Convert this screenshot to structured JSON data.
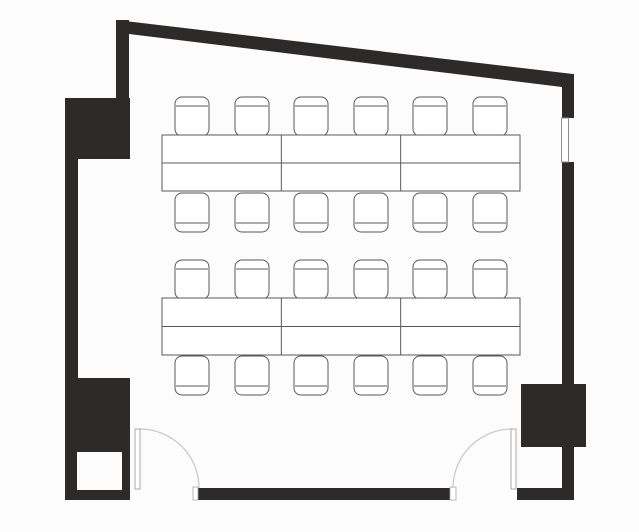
{
  "meta": {
    "drawing_type": "floor-plan",
    "room_description": "classroom seating plan",
    "table_count": 12,
    "chair_count": 24,
    "door_count": 2,
    "window_count": 1
  },
  "canvas": {
    "width": 639,
    "height": 532,
    "background": "#fcfcfc"
  },
  "style": {
    "wall_fill": "#2d2b29",
    "furniture_stroke": "#585858",
    "furniture_fill": "#ffffff",
    "arc_stroke": "#c7c7c7",
    "leaf_stroke": "#a8a8a8",
    "window_stroke": "#8f8f8f",
    "void_fill": "#fcfcfc"
  },
  "walls": [
    {
      "name": "wall-top-diagonal",
      "points": "116,20 573,74 573,88 562,87 129,34 116,33"
    },
    {
      "name": "wall-left-upper",
      "rect": [
        116,
        20,
        13,
        79
      ]
    },
    {
      "name": "wall-left-pillar",
      "rect": [
        65,
        98,
        65,
        61
      ]
    },
    {
      "name": "wall-left-strip",
      "rect": [
        65,
        158,
        13,
        221
      ]
    },
    {
      "name": "wall-left-lower-block",
      "rect": [
        65,
        378,
        65,
        122
      ]
    },
    {
      "name": "wall-bottom-left",
      "rect": [
        198,
        488,
        252,
        12
      ]
    },
    {
      "name": "wall-bottom-right",
      "rect": [
        517,
        488,
        57,
        12
      ]
    },
    {
      "name": "wall-right-lower",
      "rect": [
        562,
        446,
        12,
        54
      ]
    },
    {
      "name": "wall-right-column",
      "rect": [
        521,
        384,
        65,
        63
      ]
    },
    {
      "name": "wall-right-mid",
      "rect": [
        562,
        162,
        12,
        222
      ]
    },
    {
      "name": "wall-right-top",
      "rect": [
        562,
        74,
        12,
        44
      ]
    }
  ],
  "voids": [
    {
      "name": "wall-niche",
      "rect": [
        77,
        452,
        45,
        38
      ]
    }
  ],
  "window": {
    "name": "window-right",
    "rect": [
      561.5,
      118,
      7,
      44
    ]
  },
  "door_jambs": [
    {
      "name": "door-jamb-left",
      "rect": [
        193,
        487,
        5,
        13
      ]
    },
    {
      "name": "door-jamb-right",
      "rect": [
        450,
        487,
        6,
        13
      ]
    }
  ],
  "doors": [
    {
      "name": "door-left",
      "leaf": [
        135,
        429,
        5,
        60
      ],
      "arc": "M 140 429 A 59 59 0 0 1 199 488"
    },
    {
      "name": "door-right",
      "leaf": [
        511,
        429,
        5,
        60
      ],
      "arc": "M 512 429 A 59 59 0 0 0 453 488"
    }
  ],
  "table_bands": [
    {
      "name": "table-band-top",
      "x": 162,
      "y": 135,
      "width": 358,
      "height": 56,
      "cols": 3,
      "rows": 2
    },
    {
      "name": "table-band-bottom",
      "x": 162,
      "y": 298,
      "width": 358,
      "height": 57,
      "cols": 3,
      "rows": 2
    }
  ],
  "chair": {
    "width": 34,
    "height": 39,
    "corner_radius": 7,
    "back_inset": 9
  },
  "chair_rows": [
    {
      "name": "chair-row-1-top",
      "back": "top",
      "y": 97,
      "xs": [
        175,
        235,
        294,
        354,
        413,
        473
      ]
    },
    {
      "name": "chair-row-1-bottom",
      "back": "bottom",
      "y": 193,
      "xs": [
        175,
        235,
        294,
        354,
        413,
        473
      ]
    },
    {
      "name": "chair-row-2-top",
      "back": "top",
      "y": 260,
      "xs": [
        175,
        235,
        294,
        354,
        413,
        473
      ]
    },
    {
      "name": "chair-row-2-bottom",
      "back": "bottom",
      "y": 356,
      "xs": [
        175,
        235,
        294,
        354,
        413,
        473
      ]
    }
  ]
}
